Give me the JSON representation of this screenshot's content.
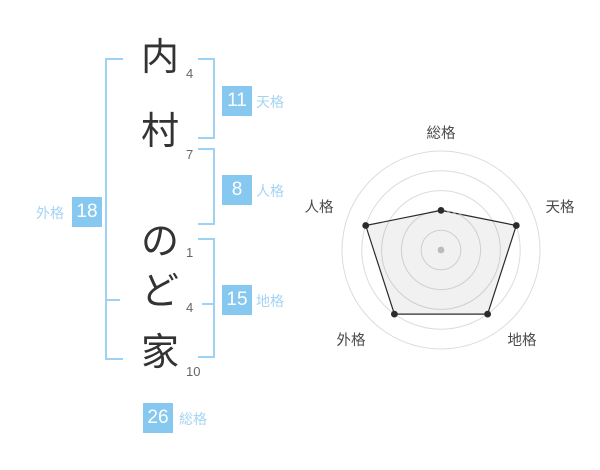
{
  "name_diagram": {
    "characters": [
      {
        "char": "内",
        "strokes": "4"
      },
      {
        "char": "村",
        "strokes": "7"
      },
      {
        "char": "の",
        "strokes": "1"
      },
      {
        "char": "ど",
        "strokes": "4"
      },
      {
        "char": "家",
        "strokes": "10"
      }
    ],
    "kaku": {
      "tenkaku": {
        "label": "天格",
        "value": "11"
      },
      "jinkaku": {
        "label": "人格",
        "value": "8"
      },
      "chikaku": {
        "label": "地格",
        "value": "15"
      },
      "gaikaku": {
        "label": "外格",
        "value": "18"
      },
      "soukaku": {
        "label": "総格",
        "value": "26"
      }
    }
  },
  "chart_data": {
    "type": "radar",
    "categories": [
      "総格",
      "天格",
      "地格",
      "外格",
      "人格"
    ],
    "values": [
      2,
      4,
      4,
      4,
      4
    ],
    "max": 5,
    "levels": 5,
    "grid": "circular",
    "legend": false,
    "title": ""
  },
  "colors": {
    "background": "#FFFFFF",
    "badge_bg": "#87C8F0",
    "badge_text": "#FFFFFF",
    "bracket": "#9DD2F4",
    "kaku_label_text": "#A5D4F3",
    "char_text": "#333333",
    "stroke_number_text": "#666666",
    "radar_grid": "#DCDCDC",
    "radar_line": "#2B2B2B",
    "radar_center_dot": "#BBBBBB",
    "radar_label_text": "#4A4A4A"
  }
}
